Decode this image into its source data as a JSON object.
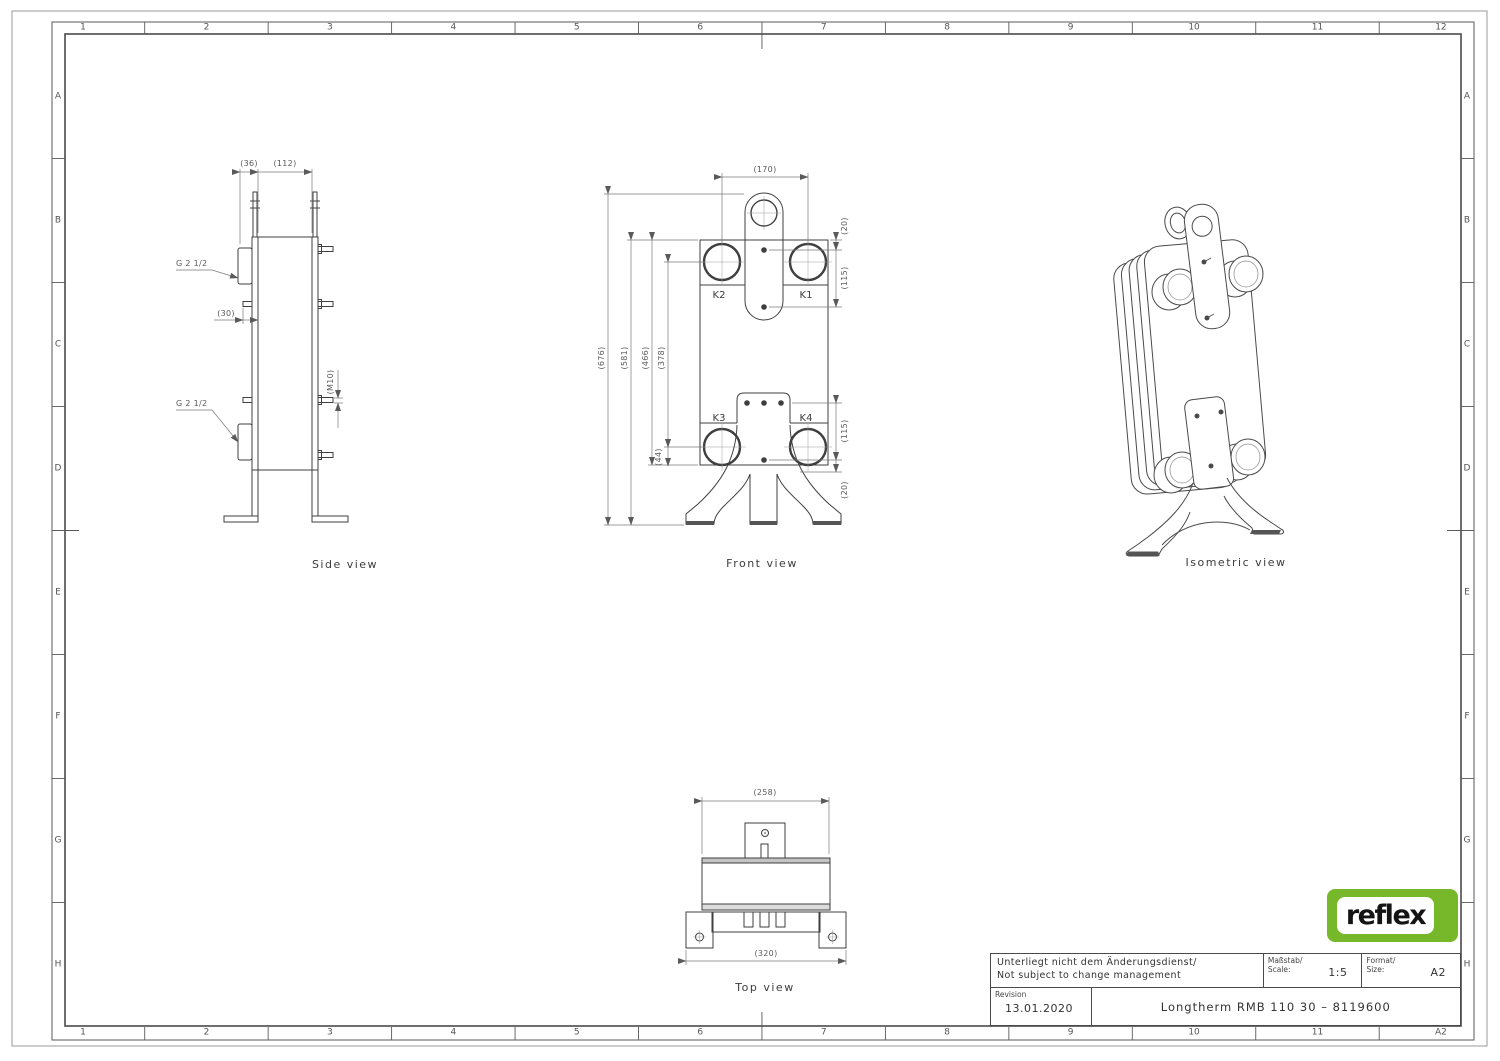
{
  "sheet": {
    "grid_top": [
      "1",
      "2",
      "3",
      "4",
      "5",
      "6",
      "7",
      "8",
      "9",
      "10",
      "11",
      "12"
    ],
    "grid_bottom": [
      "1",
      "2",
      "3",
      "4",
      "5",
      "6",
      "7",
      "8",
      "9",
      "10",
      "11",
      "A2"
    ],
    "grid_left": [
      "A",
      "B",
      "C",
      "D",
      "E",
      "F",
      "G",
      "H"
    ],
    "grid_right": [
      "A",
      "B",
      "C",
      "D",
      "E",
      "F",
      "G",
      "H"
    ]
  },
  "views": {
    "side": {
      "label": "Side view",
      "g_top": "G 2 1/2",
      "g_bottom": "G 2 1/2",
      "dims": {
        "d36": "(36)",
        "d112": "(112)",
        "d30": "(30)",
        "m10": "(M10)"
      }
    },
    "front": {
      "label": "Front view",
      "ports": {
        "k1": "K1",
        "k2": "K2",
        "k3": "K3",
        "k4": "K4"
      },
      "dims": {
        "d170": "(170)",
        "d676": "(676)",
        "d581": "(581)",
        "d466": "(466)",
        "d378": "(378)",
        "d44": "(44)",
        "d20_top": "(20)",
        "d115_top": "(115)",
        "d115_bottom": "(115)",
        "d20_bottom": "(20)"
      }
    },
    "top": {
      "label": "Top view",
      "dims": {
        "d258": "(258)",
        "d320": "(320)"
      }
    },
    "iso": {
      "label": "Isometric view"
    }
  },
  "title_block": {
    "change_note_de": "Unterliegt nicht dem Änderungsdienst/",
    "change_note_en": "Not subject to change management",
    "scale_label_de": "Maßstab/",
    "scale_label_en": "Scale:",
    "scale_value": "1:5",
    "format_label_de": "Format/",
    "format_label_en": "Size:",
    "format_value": "A2",
    "revision_label": "Revision",
    "revision_value": "13.01.2020",
    "title": "Longtherm RMB 110 30 – 8119600"
  },
  "logo": {
    "text": "reflex",
    "color": "#76b82a"
  }
}
